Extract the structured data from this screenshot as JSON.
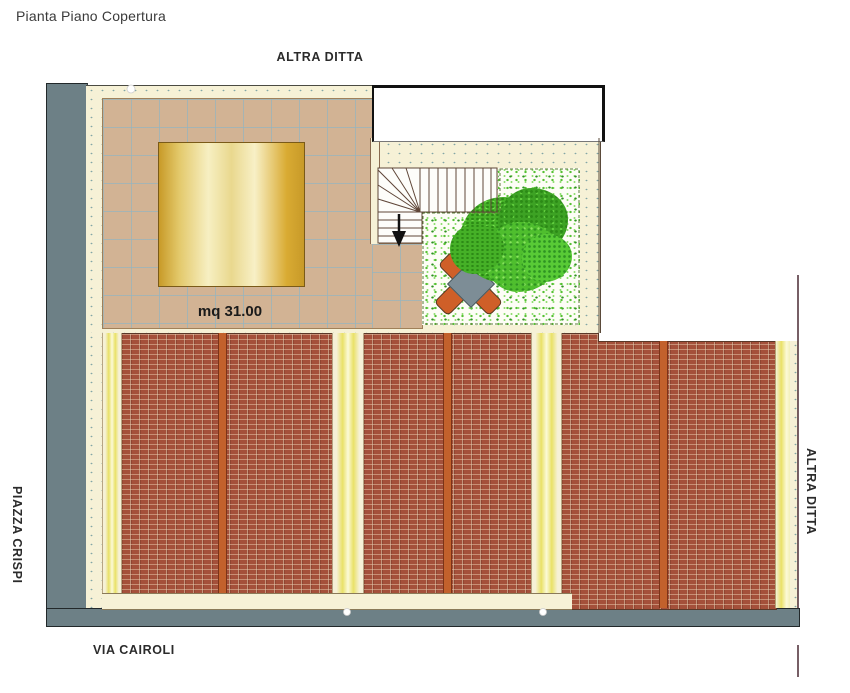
{
  "title": "Pianta Piano Copertura",
  "surroundings": {
    "top": "ALTRA DITTA",
    "right": "ALTRA DITTA",
    "bottom": "VIA CAIROLI",
    "left": "PIAZZA CRISPI"
  },
  "plan": {
    "skylight_area_label": "mq 31.00"
  },
  "legend_colors": {
    "perimeter_wall_gray": "#6d8086",
    "cream_border": "#f6f1d6",
    "terrace_tile_tan": "#d2b394",
    "tile_grid_line": "#96b4be",
    "skylight_gold_dark": "#c89a28",
    "skylight_gold_light": "#f7efc2",
    "roof_tile_red": "#a4503a",
    "roof_ridge_orange": "#c2612c",
    "valley_yellow": "#e9e167",
    "grass_green": "#56c133",
    "tree_green": "#3da224",
    "table_gray": "#7d8d96",
    "chair_orange": "#cf5f28"
  }
}
